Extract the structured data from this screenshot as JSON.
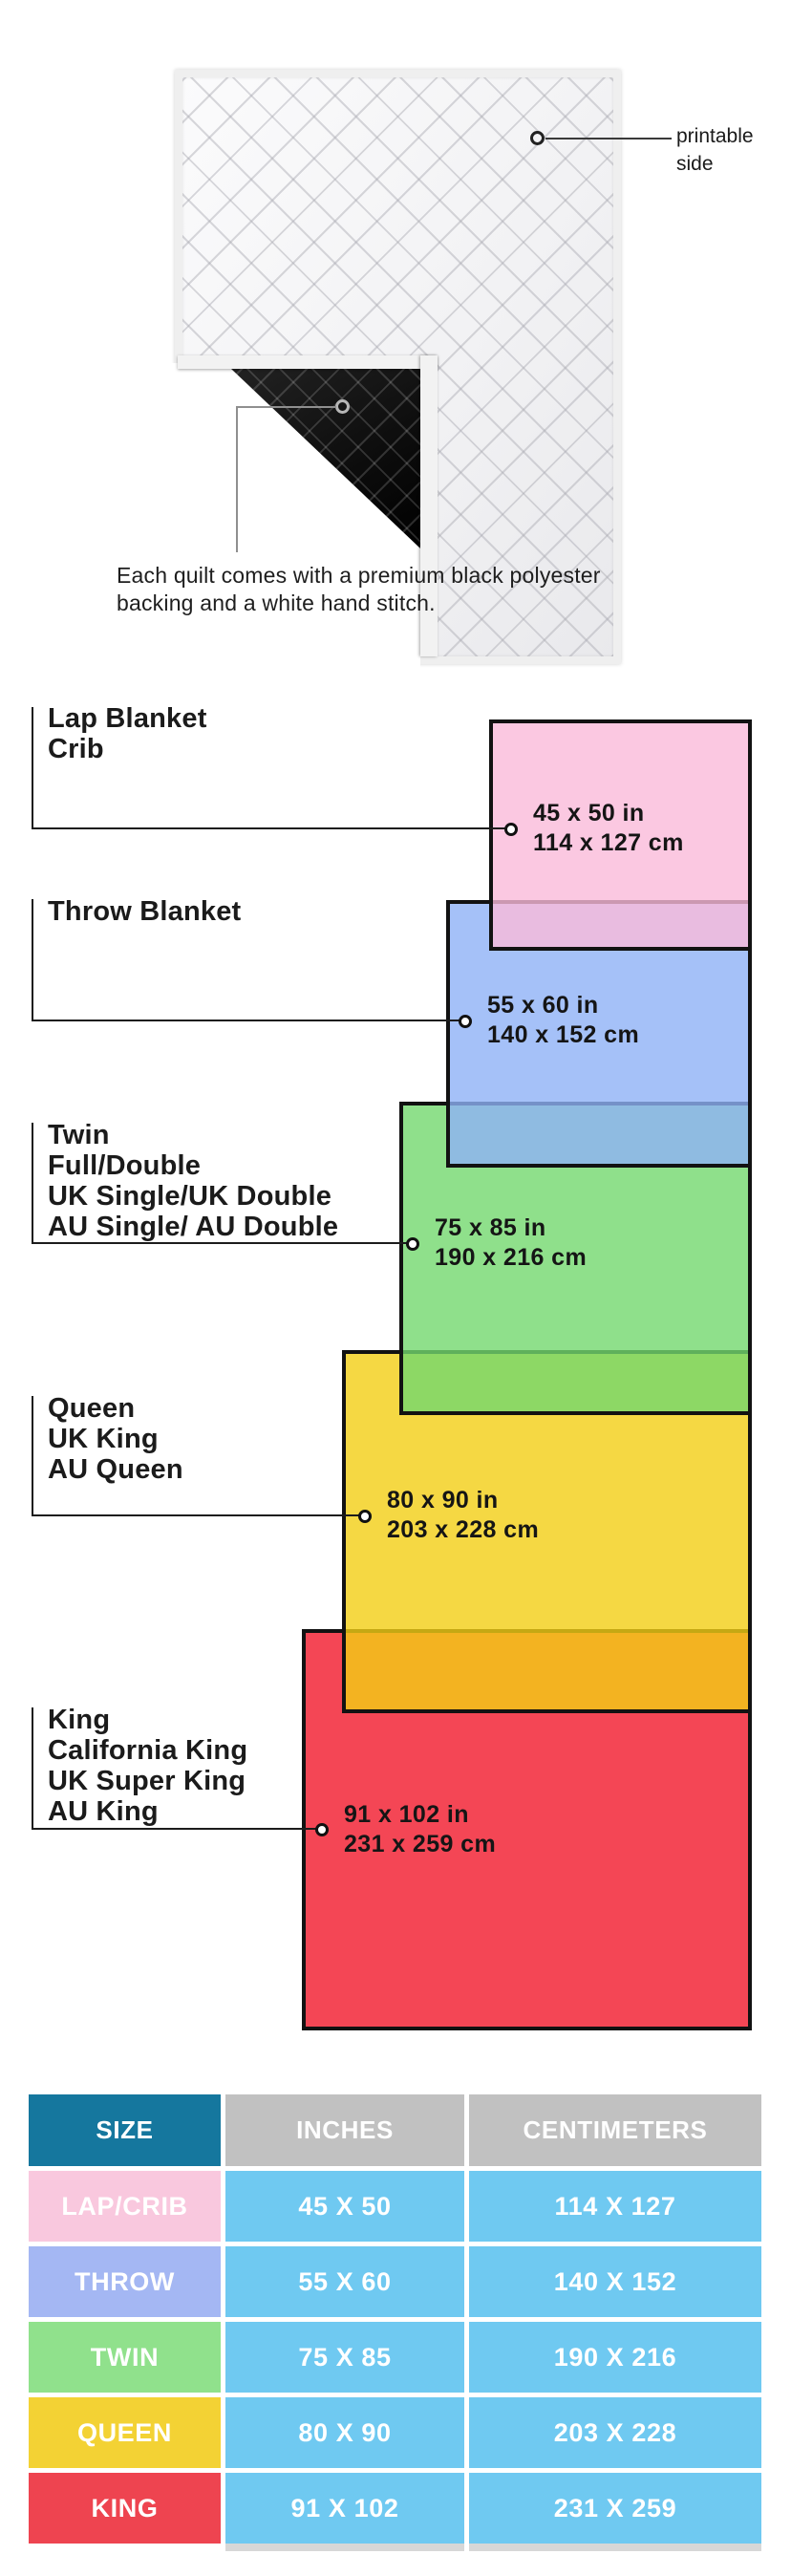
{
  "quilt": {
    "printable_label_line1": "printable",
    "printable_label_line2": "side",
    "caption_line1": "Each quilt comes with a premium black polyester",
    "caption_line2": "backing and a white hand stitch.",
    "front_color": "#f5f5f7",
    "backing_color": "#0d0d0d"
  },
  "diagram": {
    "items": [
      {
        "id": "lap-crib",
        "label_lines": [
          "Lap Blanket",
          "Crib"
        ],
        "size_in": "45 x 50 in",
        "size_cm": "114 x 127 cm",
        "color": "#fbc8e1",
        "fill": "rgba(250,186,218,0.8)"
      },
      {
        "id": "throw",
        "label_lines": [
          "Throw Blanket"
        ],
        "size_in": "55 x 60 in",
        "size_cm": "140 x 152 cm",
        "color": "#a5c1f8",
        "fill": "rgba(142,177,246,0.8)"
      },
      {
        "id": "twin",
        "label_lines": [
          "Twin",
          "Full/Double",
          "UK Single/UK Double",
          "AU Single/ AU Double"
        ],
        "size_in": "75 x 85 in",
        "size_cm": "190 x 216 cm",
        "color": "#8fe08b",
        "fill": "rgba(115,216,110,0.8)"
      },
      {
        "id": "queen",
        "label_lines": [
          "Queen",
          "UK King",
          "AU Queen"
        ],
        "size_in": "80 x 90 in",
        "size_cm": "203 x 228 cm",
        "color": "#f5d843",
        "fill": "rgba(242,206,20,0.8)"
      },
      {
        "id": "king",
        "label_lines": [
          "King",
          "California King",
          "UK Super King",
          "AU King"
        ],
        "size_in": "91 x 102 in",
        "size_cm": "231 x 259 cm",
        "color": "#f44655",
        "fill": "rgba(241,24,43,0.8)"
      }
    ]
  },
  "table": {
    "headers": {
      "size": "SIZE",
      "inches": "INCHES",
      "centimeters": "CENTIMETERS"
    },
    "header_size_bg": "#15779e",
    "header_metric_bg": "#c1c1c1",
    "data_cell_bg": "#6fc9f1",
    "rows": [
      {
        "size": "LAP/CRIB",
        "inches": "45 X 50",
        "centimeters": "114 X 127",
        "color": "#f9c8de"
      },
      {
        "size": "THROW",
        "inches": "55 X 60",
        "centimeters": "140 X 152",
        "color": "#a4b7f3"
      },
      {
        "size": "TWIN",
        "inches": "75 X 85",
        "centimeters": "190 X 216",
        "color": "#90e18c"
      },
      {
        "size": "QUEEN",
        "inches": "80 X 90",
        "centimeters": "203 X 228",
        "color": "#f3d234"
      },
      {
        "size": "KING",
        "inches": "91 X 102",
        "centimeters": "231 X 259",
        "color": "#ee4450"
      }
    ]
  }
}
